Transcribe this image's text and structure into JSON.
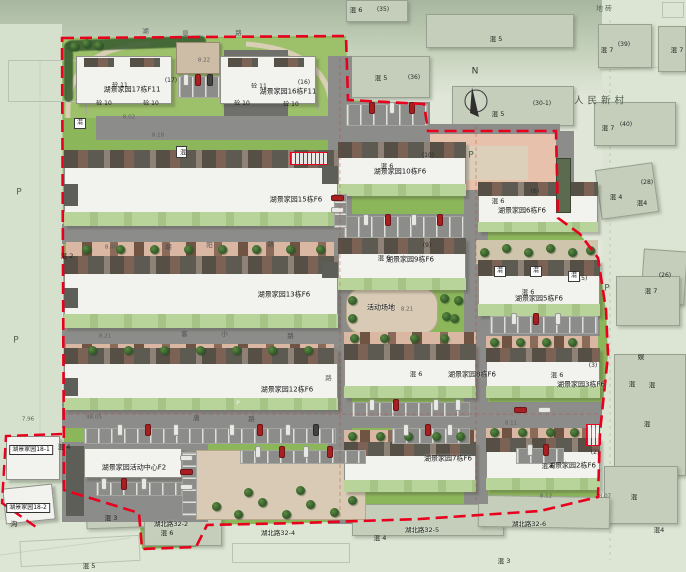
{
  "title": "湖景家园 小区总平面图",
  "colors": {
    "boundary": "#e8001d",
    "lawn": "#8cb65a",
    "lawn_light": "#9dc06a",
    "road": "#8a8a8a",
    "building": "#f2f2ee",
    "pink_parking": "#e7c1ac",
    "plaza_tan": "#d8cab4",
    "tree": "#2f5d2c",
    "car_red": "#a81f22"
  },
  "compass": {
    "label": "N"
  },
  "shapes": [
    [
      "ob",
      346,
      0,
      62,
      22
    ],
    [
      "ob",
      426,
      14,
      148,
      34
    ],
    [
      "ob",
      346,
      56,
      84,
      42
    ],
    [
      "ob",
      452,
      86,
      122,
      40
    ],
    [
      "ob",
      598,
      24,
      54,
      44
    ],
    [
      "ob",
      658,
      26,
      28,
      46
    ],
    [
      "ob",
      594,
      102,
      82,
      44
    ],
    [
      "ob",
      598,
      166,
      58,
      50,
      -8
    ],
    [
      "ob",
      642,
      250,
      44,
      54,
      4
    ],
    [
      "ob",
      616,
      276,
      64,
      50
    ],
    [
      "ob",
      614,
      354,
      72,
      122
    ],
    [
      "ob",
      604,
      466,
      74,
      58
    ],
    [
      "ob",
      352,
      504,
      152,
      32
    ],
    [
      "ob",
      478,
      496,
      132,
      32,
      1
    ],
    [
      "ob",
      86,
      498,
      74,
      30,
      -2
    ],
    [
      "ob",
      144,
      504,
      78,
      42
    ],
    [
      "os",
      20,
      538,
      120,
      26,
      -3
    ],
    [
      "os",
      232,
      543,
      118,
      20
    ],
    [
      "os",
      662,
      2,
      22,
      16
    ],
    [
      "os",
      8,
      60,
      118,
      42
    ],
    [
      "conif",
      66,
      38,
      140,
      11,
      -2
    ],
    [
      "conif",
      64,
      42,
      9,
      60
    ],
    [
      "rddark",
      224,
      50,
      64,
      76
    ],
    [
      "gar",
      176,
      42,
      44,
      32
    ],
    [
      "rd",
      96,
      116,
      250,
      24
    ],
    [
      "rd",
      344,
      102,
      86,
      28
    ],
    [
      "rd",
      336,
      124,
      224,
      20
    ],
    [
      "rd",
      328,
      56,
      24,
      468
    ],
    [
      "rd",
      62,
      224,
      268,
      20
    ],
    [
      "rd",
      62,
      326,
      268,
      20
    ],
    [
      "rd",
      62,
      402,
      540,
      26
    ],
    [
      "rd",
      464,
      124,
      24,
      380
    ],
    [
      "rd",
      340,
      214,
      126,
      26
    ],
    [
      "rd",
      488,
      314,
      112,
      22
    ],
    [
      "rd",
      62,
      442,
      146,
      80
    ],
    [
      "rd",
      556,
      131,
      18,
      90
    ],
    [
      "pink",
      430,
      134,
      126,
      56
    ],
    [
      "tan",
      452,
      146,
      76,
      34
    ],
    [
      "plaza",
      196,
      450,
      170,
      70
    ],
    [
      "plaza",
      346,
      288,
      92,
      46,
      0,
      16
    ],
    [
      "tanpath",
      476,
      240,
      122,
      24
    ],
    [
      "ps",
      66,
      242,
      268,
      15
    ],
    [
      "ps",
      66,
      344,
      268,
      13
    ],
    [
      "ps",
      344,
      332,
      132,
      12
    ],
    [
      "ps",
      486,
      336,
      112,
      12
    ],
    [
      "ps",
      344,
      430,
      132,
      12
    ],
    [
      "ps",
      486,
      428,
      112,
      10
    ],
    [
      "b",
      76,
      56,
      96,
      48
    ],
    [
      "roof",
      84,
      58,
      30,
      9
    ],
    [
      "roof",
      130,
      58,
      30,
      9
    ],
    [
      "b",
      220,
      56,
      96,
      48
    ],
    [
      "roof",
      228,
      58,
      30,
      9
    ],
    [
      "roof",
      274,
      58,
      30,
      9
    ],
    [
      "b",
      64,
      150,
      274,
      76
    ],
    [
      "roof",
      64,
      150,
      274,
      18
    ],
    [
      "gs",
      64,
      212,
      274,
      14
    ],
    [
      "core",
      64,
      184,
      14,
      22
    ],
    [
      "core",
      322,
      166,
      16,
      18
    ],
    [
      "b",
      64,
      256,
      274,
      72
    ],
    [
      "roof",
      64,
      256,
      274,
      18
    ],
    [
      "gs",
      64,
      314,
      274,
      14
    ],
    [
      "core",
      64,
      288,
      14,
      20
    ],
    [
      "core",
      322,
      262,
      16,
      16
    ],
    [
      "b",
      64,
      348,
      274,
      62
    ],
    [
      "roof",
      64,
      348,
      274,
      16
    ],
    [
      "gs",
      64,
      398,
      274,
      12
    ],
    [
      "core",
      64,
      378,
      14,
      18
    ],
    [
      "b",
      338,
      142,
      128,
      54
    ],
    [
      "roof",
      338,
      142,
      128,
      16
    ],
    [
      "gs",
      338,
      184,
      128,
      12
    ],
    [
      "b",
      338,
      238,
      128,
      52
    ],
    [
      "roof",
      338,
      238,
      128,
      16
    ],
    [
      "gs",
      338,
      278,
      128,
      12
    ],
    [
      "b",
      344,
      344,
      132,
      54
    ],
    [
      "roof",
      344,
      344,
      132,
      16
    ],
    [
      "gs",
      344,
      386,
      132,
      12
    ],
    [
      "b",
      344,
      442,
      132,
      50
    ],
    [
      "roof",
      344,
      442,
      132,
      14
    ],
    [
      "gs",
      344,
      480,
      132,
      12
    ],
    [
      "b",
      478,
      182,
      120,
      50
    ],
    [
      "roof",
      478,
      182,
      120,
      14
    ],
    [
      "gs",
      478,
      222,
      120,
      10
    ],
    [
      "b",
      478,
      260,
      122,
      56
    ],
    [
      "roof",
      478,
      260,
      122,
      16
    ],
    [
      "gs",
      478,
      304,
      122,
      12
    ],
    [
      "b",
      486,
      348,
      114,
      50
    ],
    [
      "roof",
      486,
      348,
      114,
      14
    ],
    [
      "gs",
      486,
      386,
      114,
      12
    ],
    [
      "b",
      486,
      438,
      114,
      52
    ],
    [
      "roof",
      486,
      438,
      114,
      14
    ],
    [
      "gs",
      486,
      478,
      114,
      12
    ],
    [
      "b",
      84,
      448,
      98,
      30
    ],
    [
      "core",
      66,
      446,
      18,
      70
    ],
    [
      "b",
      6,
      436,
      54,
      44
    ],
    [
      "b",
      4,
      486,
      50,
      36,
      -6
    ],
    [
      "shed",
      556,
      158,
      15,
      55
    ],
    [
      "sv",
      178,
      76,
      42,
      22
    ],
    [
      "sv",
      346,
      104,
      82,
      22
    ],
    [
      "sv",
      344,
      216,
      120,
      22
    ],
    [
      "sh2",
      334,
      194,
      13,
      34
    ],
    [
      "sv",
      352,
      402,
      118,
      15
    ],
    [
      "sv",
      84,
      428,
      252,
      16
    ],
    [
      "sv",
      392,
      428,
      78,
      16
    ],
    [
      "sv",
      490,
      316,
      108,
      18
    ],
    [
      "sh2",
      182,
      452,
      15,
      64
    ],
    [
      "sv",
      240,
      450,
      126,
      14
    ],
    [
      "sv",
      516,
      448,
      48,
      16
    ],
    [
      "sv",
      96,
      482,
      86,
      14
    ]
  ],
  "cars": [
    [
      186,
      80,
      "w",
      1
    ],
    [
      198,
      80,
      "r",
      1
    ],
    [
      210,
      80,
      "d",
      1
    ],
    [
      372,
      108,
      "r",
      1
    ],
    [
      392,
      108,
      "w",
      1
    ],
    [
      412,
      108,
      "r",
      1
    ],
    [
      366,
      220,
      "w",
      1
    ],
    [
      388,
      220,
      "r",
      1
    ],
    [
      414,
      220,
      "w",
      1
    ],
    [
      440,
      220,
      "r",
      1
    ],
    [
      337,
      198,
      "r",
      0
    ],
    [
      337,
      210,
      "w",
      0
    ],
    [
      372,
      405,
      "w",
      1
    ],
    [
      396,
      405,
      "r",
      1
    ],
    [
      436,
      405,
      "w",
      1
    ],
    [
      458,
      405,
      "w",
      1
    ],
    [
      120,
      430,
      "w",
      1
    ],
    [
      148,
      430,
      "r",
      1
    ],
    [
      176,
      430,
      "w",
      1
    ],
    [
      232,
      430,
      "w",
      1
    ],
    [
      260,
      430,
      "r",
      1
    ],
    [
      288,
      430,
      "w",
      1
    ],
    [
      316,
      430,
      "d",
      1
    ],
    [
      406,
      430,
      "w",
      1
    ],
    [
      428,
      430,
      "r",
      1
    ],
    [
      450,
      430,
      "w",
      1
    ],
    [
      514,
      319,
      "w",
      1
    ],
    [
      536,
      319,
      "r",
      1
    ],
    [
      558,
      319,
      "w",
      1
    ],
    [
      520,
      410,
      "r",
      0
    ],
    [
      544,
      410,
      "w",
      0
    ],
    [
      186,
      458,
      "w",
      0
    ],
    [
      186,
      472,
      "r",
      0
    ],
    [
      186,
      487,
      "w",
      0
    ],
    [
      258,
      452,
      "w",
      1
    ],
    [
      282,
      452,
      "r",
      1
    ],
    [
      306,
      452,
      "w",
      1
    ],
    [
      330,
      452,
      "r",
      1
    ],
    [
      104,
      484,
      "w",
      1
    ],
    [
      124,
      484,
      "r",
      1
    ],
    [
      144,
      484,
      "w",
      1
    ],
    [
      530,
      450,
      "w",
      1
    ],
    [
      546,
      450,
      "r",
      1
    ]
  ],
  "trees": [
    [
      86,
      249
    ],
    [
      120,
      249
    ],
    [
      154,
      249
    ],
    [
      188,
      249
    ],
    [
      222,
      249
    ],
    [
      256,
      249
    ],
    [
      290,
      249
    ],
    [
      320,
      249
    ],
    [
      92,
      350
    ],
    [
      128,
      350
    ],
    [
      164,
      350
    ],
    [
      200,
      350
    ],
    [
      236,
      350
    ],
    [
      272,
      350
    ],
    [
      308,
      350
    ],
    [
      354,
      338
    ],
    [
      384,
      338
    ],
    [
      414,
      338
    ],
    [
      444,
      338
    ],
    [
      494,
      342
    ],
    [
      520,
      342
    ],
    [
      546,
      342
    ],
    [
      572,
      342
    ],
    [
      352,
      436
    ],
    [
      380,
      436
    ],
    [
      408,
      436
    ],
    [
      436,
      436
    ],
    [
      460,
      436
    ],
    [
      494,
      432
    ],
    [
      522,
      432
    ],
    [
      550,
      432
    ],
    [
      574,
      432
    ],
    [
      484,
      252
    ],
    [
      506,
      248
    ],
    [
      528,
      252
    ],
    [
      550,
      248
    ],
    [
      572,
      252
    ],
    [
      590,
      250
    ],
    [
      352,
      300
    ],
    [
      352,
      318
    ],
    [
      444,
      298
    ],
    [
      446,
      316
    ],
    [
      216,
      506
    ],
    [
      238,
      514
    ],
    [
      262,
      502
    ],
    [
      286,
      514
    ],
    [
      310,
      504
    ],
    [
      334,
      512
    ],
    [
      352,
      500
    ],
    [
      248,
      492
    ],
    [
      300,
      490
    ],
    [
      74,
      46
    ],
    [
      86,
      43
    ],
    [
      98,
      45
    ],
    [
      458,
      300
    ],
    [
      454,
      318
    ]
  ],
  "mboxes": [
    [
      74,
      118,
      "混",
      0
    ],
    [
      176,
      146,
      "混",
      1
    ],
    [
      494,
      266,
      "混",
      0
    ],
    [
      530,
      266,
      "混",
      0
    ],
    [
      568,
      271,
      "混",
      0
    ]
  ],
  "redboxes": [
    [
      290,
      152,
      36,
      11
    ],
    [
      586,
      424,
      12,
      20
    ]
  ],
  "labels": [
    [
      "湖景家园17栋F11",
      132,
      90,
      "bl"
    ],
    [
      "湖景家园16栋F11",
      288,
      92,
      "bl"
    ],
    [
      "湖景家园15栋F6",
      296,
      200,
      "bl"
    ],
    [
      "湖景家园13栋F6",
      284,
      295,
      "bl"
    ],
    [
      "湖景家园12栋F6",
      287,
      390,
      "bl"
    ],
    [
      "湖景家园10栋F6",
      400,
      172,
      "bl"
    ],
    [
      "湖景家园9栋F6",
      410,
      260,
      "bl"
    ],
    [
      "湖景家园8栋F6",
      472,
      375,
      "bl"
    ],
    [
      "湖景家园7栋F6",
      448,
      459,
      "bl"
    ],
    [
      "湖景家园6栋F6",
      522,
      211,
      "bl"
    ],
    [
      "湖景家园5栋F6",
      539,
      299,
      "bl"
    ],
    [
      "湖景家园3栋F6",
      581,
      385,
      "bl"
    ],
    [
      "湖景家园2栋F6",
      572,
      466,
      "bl"
    ],
    [
      "湖景家园活动中心F2",
      134,
      468,
      "bl"
    ],
    [
      "活动场地",
      381,
      308,
      "bl"
    ],
    [
      "混 6",
      387,
      166,
      "hl"
    ],
    [
      "混 6",
      384,
      258,
      "hl"
    ],
    [
      "混 6",
      498,
      201,
      "hl"
    ],
    [
      "混 6",
      528,
      292,
      "hl"
    ],
    [
      "混 6",
      416,
      374,
      "hl"
    ],
    [
      "混 6",
      557,
      375,
      "hl"
    ],
    [
      "混 6",
      548,
      466,
      "hl"
    ],
    [
      "混 6",
      167,
      533,
      "hl"
    ],
    [
      "混 6",
      356,
      10,
      "hl"
    ],
    [
      "混 5",
      496,
      39,
      "hl"
    ],
    [
      "混 5",
      381,
      78,
      "hl"
    ],
    [
      "混 5",
      498,
      114,
      "hl"
    ],
    [
      "混 5",
      89,
      566,
      "hl"
    ],
    [
      "混 7",
      607,
      50,
      "hl"
    ],
    [
      "混 7",
      677,
      50,
      "hl"
    ],
    [
      "混 7",
      608,
      128,
      "hl"
    ],
    [
      "混 7",
      651,
      291,
      "hl"
    ],
    [
      "混 4",
      64,
      447,
      "hl"
    ],
    [
      "混 4",
      616,
      197,
      "hl"
    ],
    [
      "混4",
      642,
      203,
      "hl"
    ],
    [
      "混 4",
      380,
      538,
      "hl"
    ],
    [
      "混4",
      659,
      530,
      "hl"
    ],
    [
      "混 3",
      111,
      518,
      "hl"
    ],
    [
      "混 3",
      504,
      561,
      "hl"
    ],
    [
      "混 2",
      67,
      256,
      "hl"
    ],
    [
      "娱",
      641,
      357,
      "hl"
    ],
    [
      "混",
      632,
      384,
      "hl"
    ],
    [
      "混",
      652,
      385,
      "hl"
    ],
    [
      "混",
      647,
      424,
      "hl"
    ],
    [
      "混",
      634,
      497,
      "hl"
    ],
    [
      "沟",
      14,
      524,
      "hl"
    ],
    [
      "(17)",
      171,
      81,
      "pr"
    ],
    [
      "(16)",
      304,
      83,
      "pr"
    ],
    [
      "(10)",
      428,
      156,
      "pr"
    ],
    [
      "(9)",
      427,
      246,
      "pr"
    ],
    [
      "(6)",
      535,
      192,
      "pr"
    ],
    [
      "(5)",
      583,
      279,
      "pr"
    ],
    [
      "(3)",
      593,
      366,
      "pr"
    ],
    [
      "(2)",
      595,
      453,
      "pr"
    ],
    [
      "(35)",
      383,
      10,
      "pr"
    ],
    [
      "(36)",
      414,
      78,
      "pr"
    ],
    [
      "(39)",
      624,
      45,
      "pr"
    ],
    [
      "(40)",
      626,
      125,
      "pr"
    ],
    [
      "(30-1)",
      542,
      104,
      "pr"
    ],
    [
      "(28)",
      647,
      183,
      "pr"
    ],
    [
      "(26)",
      665,
      276,
      "pr"
    ],
    [
      "砼 10",
      104,
      104,
      "zt"
    ],
    [
      "砼 10",
      151,
      104,
      "zt"
    ],
    [
      "砼 10",
      242,
      104,
      "zt"
    ],
    [
      "砼 10",
      291,
      105,
      "zt"
    ],
    [
      "砼 11",
      120,
      86,
      "zt"
    ],
    [
      "砼 11",
      259,
      87,
      "zt"
    ],
    [
      "湖景家园18-1",
      31,
      450,
      "adbox"
    ],
    [
      "湖景家园18-2",
      28,
      508,
      "adbox"
    ],
    [
      "湖北路32-2",
      171,
      524,
      "ad"
    ],
    [
      "湖北路32-4",
      278,
      533,
      "ad"
    ],
    [
      "湖北路32-5",
      422,
      530,
      "ad"
    ],
    [
      "湖北路32-6",
      529,
      524,
      "ad"
    ],
    [
      "人民新村",
      601,
      101,
      "big"
    ],
    [
      "地砖",
      605,
      9,
      "gy"
    ],
    [
      "P",
      19,
      193,
      "pl"
    ],
    [
      "P",
      16,
      341,
      "pl"
    ],
    [
      "P",
      471,
      156,
      "pl"
    ],
    [
      "P",
      607,
      289,
      "pl"
    ],
    [
      "P",
      238,
      404,
      "plw"
    ],
    [
      "8.22",
      204,
      61,
      "el"
    ],
    [
      "8.02",
      129,
      118,
      "el"
    ],
    [
      "8.18",
      158,
      136,
      "el"
    ],
    [
      "8.46",
      111,
      248,
      "el"
    ],
    [
      "8.21",
      105,
      337,
      "el"
    ],
    [
      "8.21",
      407,
      310,
      "el"
    ],
    [
      "48.05",
      94,
      418,
      "el"
    ],
    [
      "7.96",
      28,
      420,
      "el"
    ],
    [
      "8.11",
      511,
      424,
      "el"
    ],
    [
      "8.12",
      546,
      497,
      "el"
    ],
    [
      "8.07",
      605,
      497,
      "el"
    ],
    [
      "湖",
      146,
      31,
      "rc"
    ],
    [
      "景",
      186,
      34,
      "rc"
    ],
    [
      "路",
      239,
      33,
      "rc"
    ],
    [
      "客",
      185,
      334,
      "rc"
    ],
    [
      "小",
      225,
      334,
      "rc"
    ],
    [
      "路",
      291,
      336,
      "rc"
    ],
    [
      "朝",
      169,
      247,
      "rc"
    ],
    [
      "阳",
      210,
      245,
      "rc"
    ],
    [
      "路",
      271,
      244,
      "rc"
    ],
    [
      "唐",
      197,
      418,
      "rc"
    ],
    [
      "路",
      252,
      419,
      "rc"
    ],
    [
      "路",
      329,
      378,
      "rc"
    ],
    [
      "N",
      475,
      72,
      "nl"
    ]
  ]
}
